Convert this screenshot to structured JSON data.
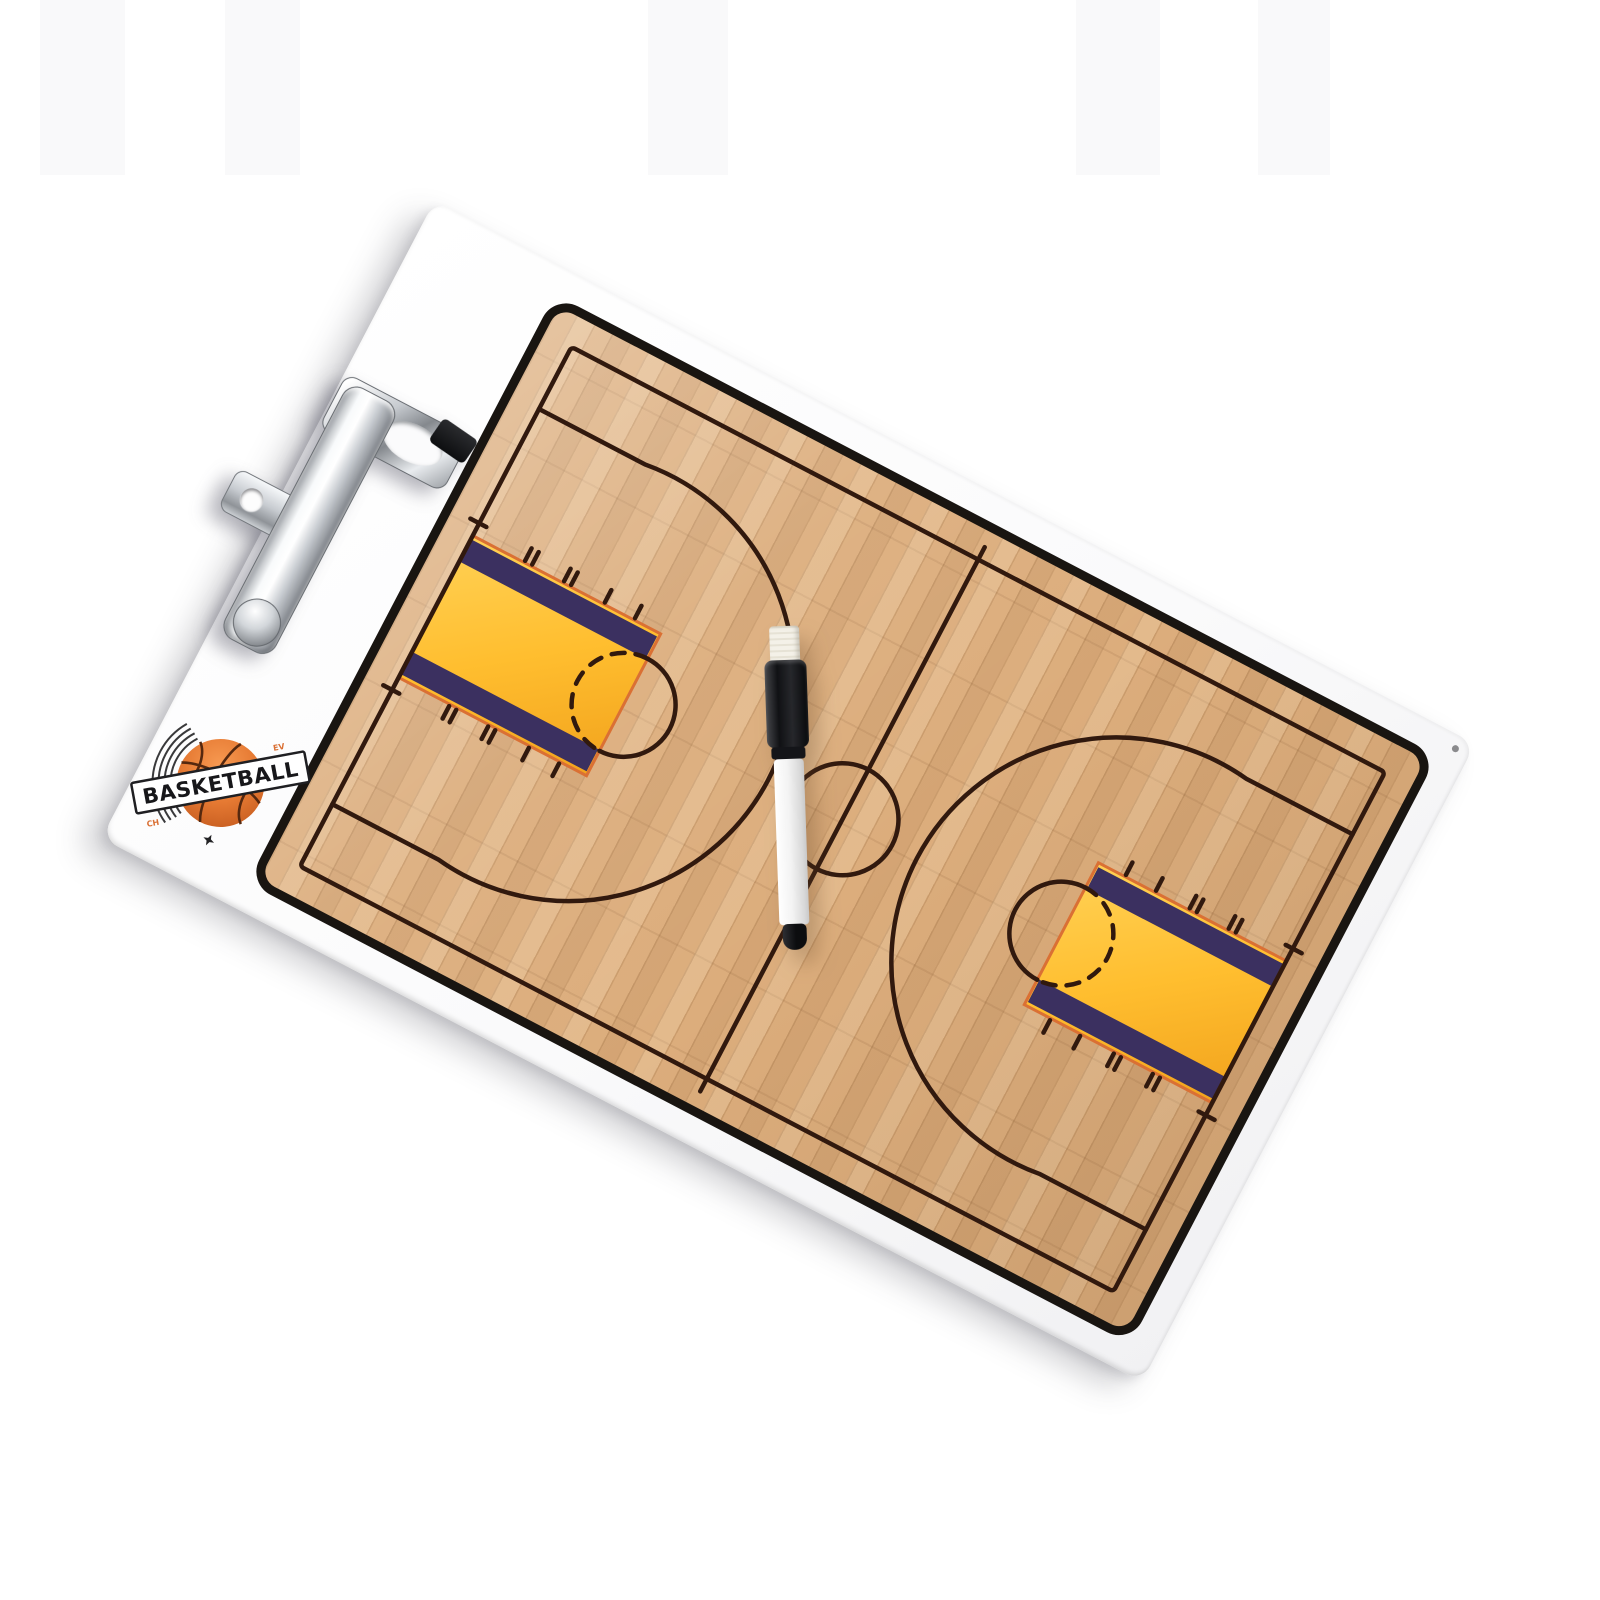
{
  "scene": {
    "description": "Product photo of a white basketball coaching clipboard with printed wooden court, chrome low-profile clip, and a black-capped dry-erase marker lying on the center circle",
    "background": "#ffffff"
  },
  "logo": {
    "title": "BASKETBALL",
    "micro_text_top": "EV",
    "micro_text_bottom": "CH"
  },
  "colors": {
    "board_face": "#fafafb",
    "court_border": "#191511",
    "court_line": "#31190e",
    "wood_base": "#dcad7c",
    "key_fill": "#ffbe2f",
    "key_fill_deep": "#f2a31d",
    "key_band": "#3b3060",
    "key_outline": "#da7034",
    "ball_orange": "#e67a33",
    "chrome_mid": "#c7cbd0",
    "chrome_dark": "#585c60",
    "pen_cap": "#141416",
    "pen_barrel": "#f5f5f5",
    "pen_eraser": "#f2efe6"
  }
}
